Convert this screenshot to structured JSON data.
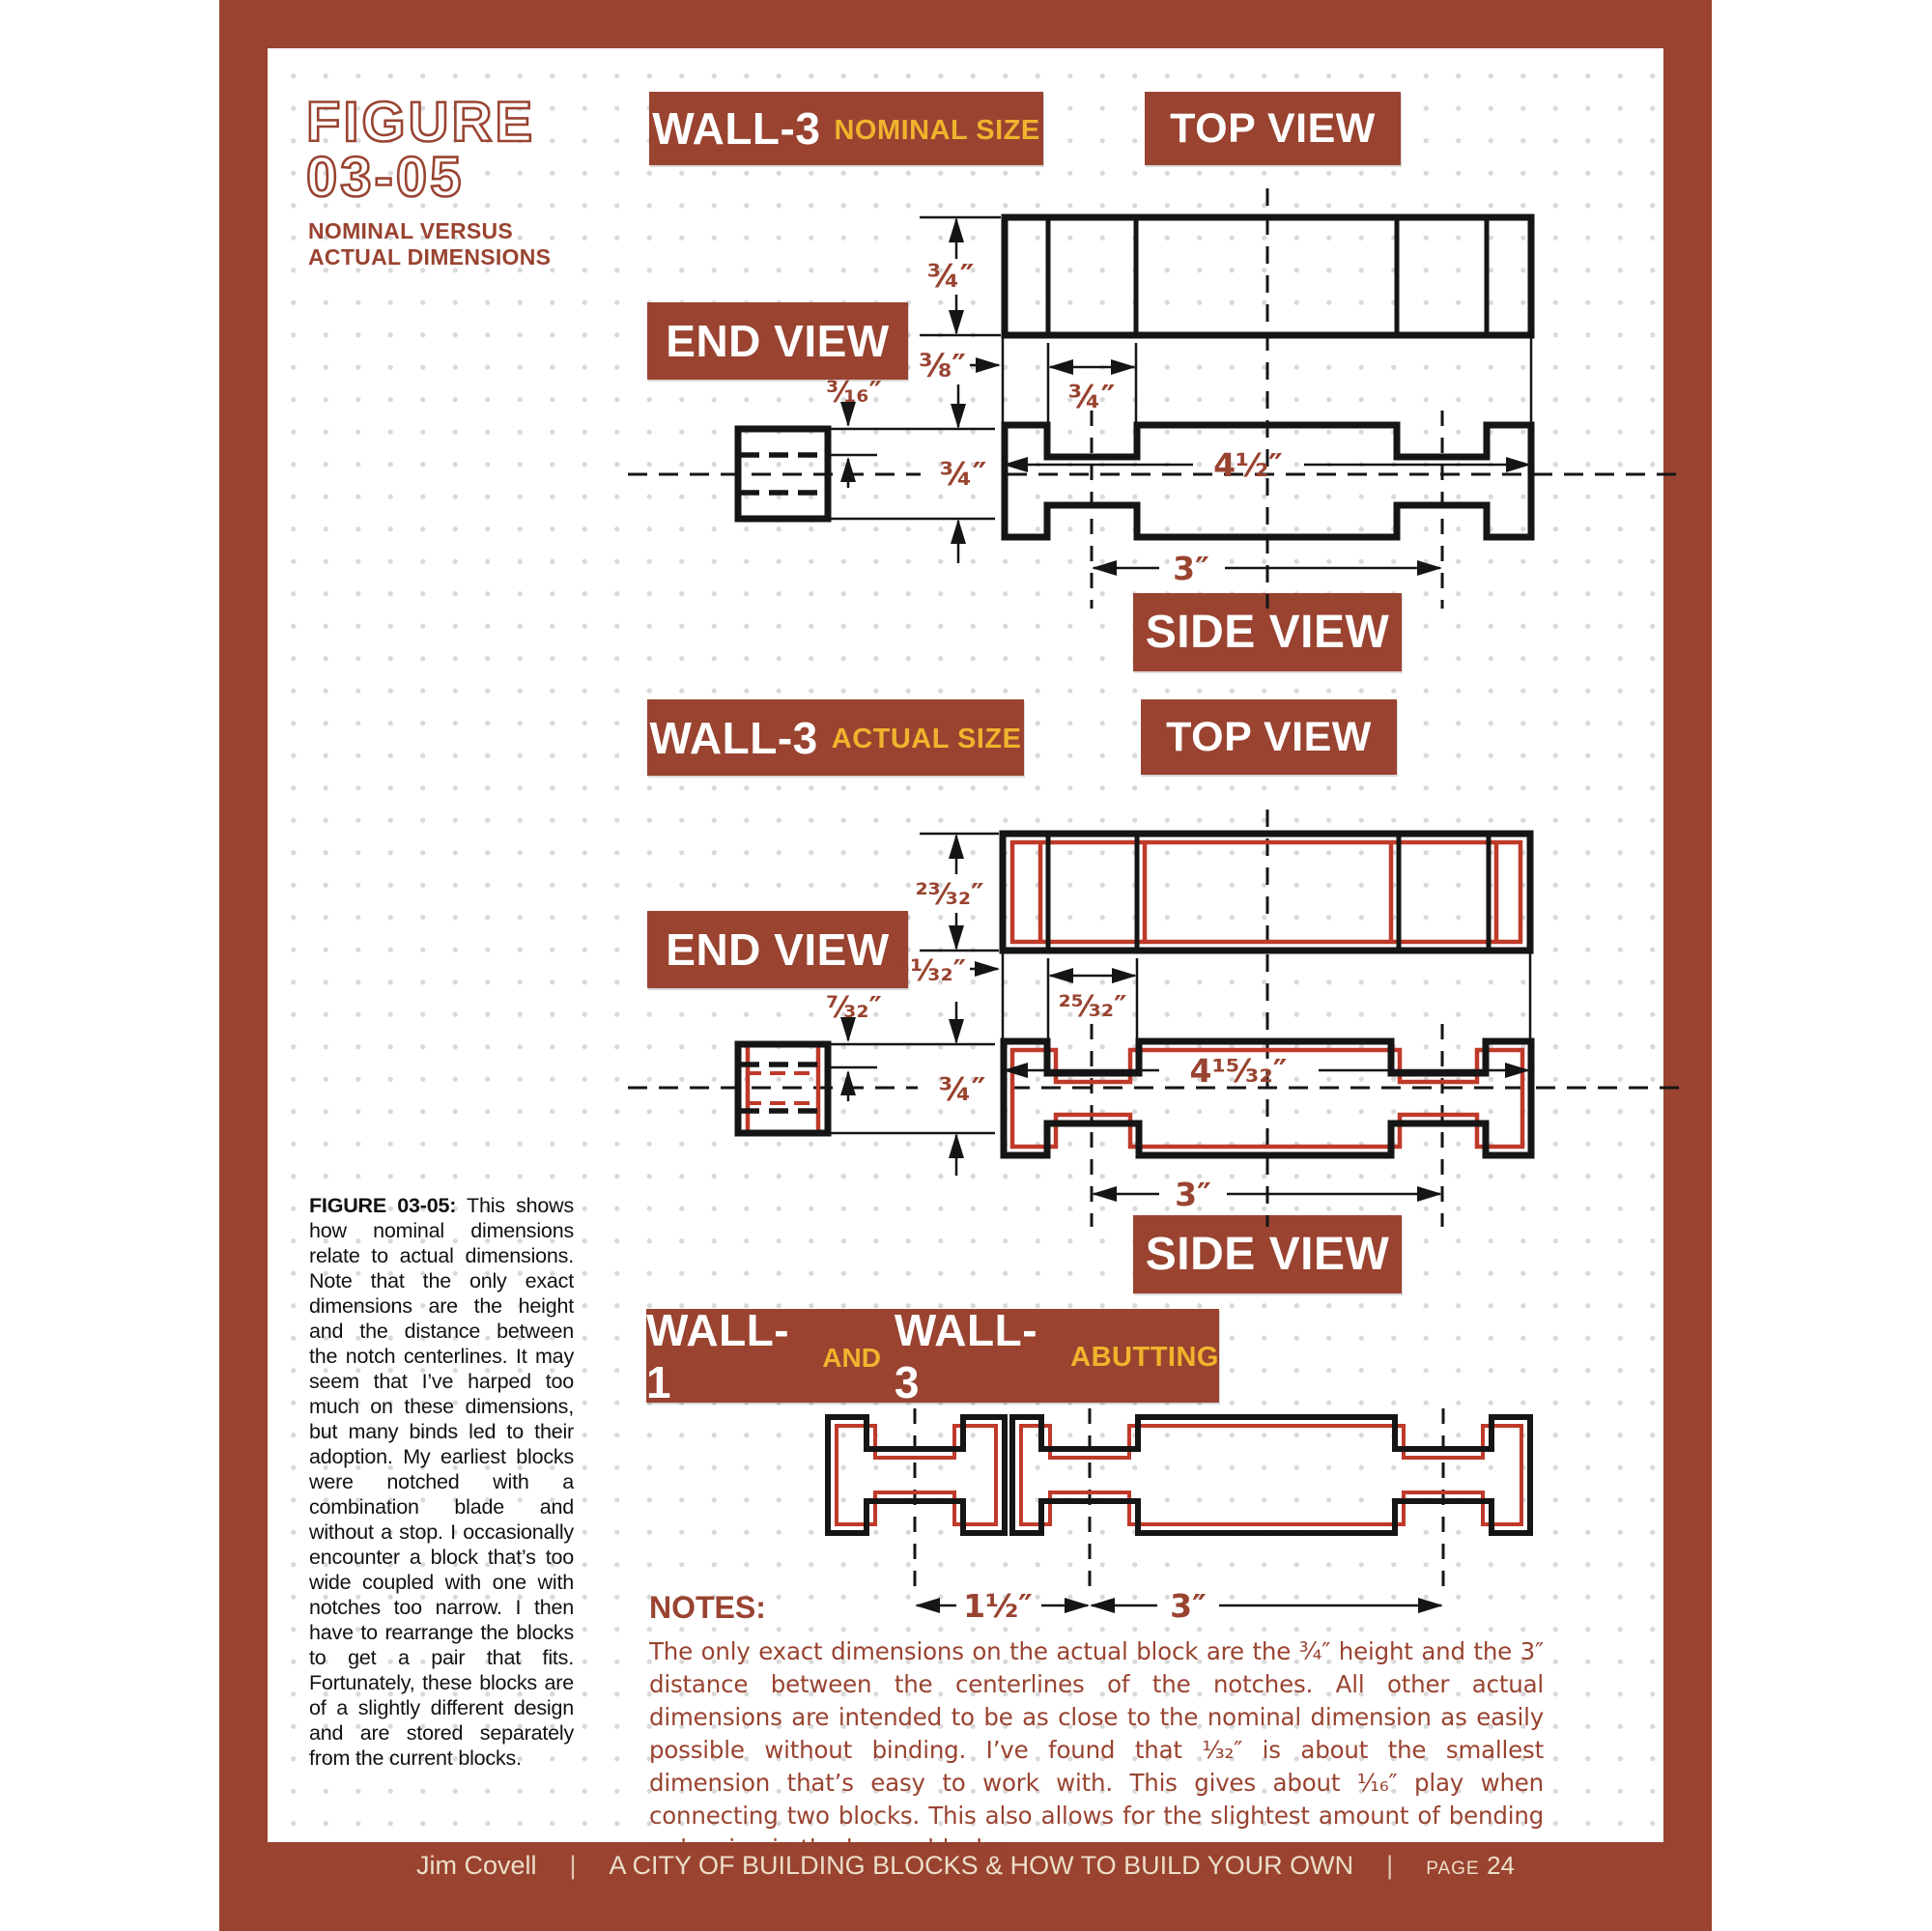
{
  "figure": {
    "label_line1": "FIGURE",
    "label_line2": "03-05",
    "subtitle_line1": "NOMINAL VERSUS",
    "subtitle_line2": "ACTUAL DIMENSIONS"
  },
  "colors": {
    "brick": "#994330",
    "accent_yellow": "#f0b32d",
    "overlay_red": "#bf3a2a",
    "ink": "#151515",
    "footer_text": "#ecdfc9"
  },
  "sections": {
    "nominal": {
      "title": "WALL-3",
      "title_suffix": "NOMINAL SIZE",
      "top_view_label": "TOP VIEW",
      "end_view_label": "END VIEW",
      "side_view_label": "SIDE VIEW",
      "dims": {
        "height": "¾″",
        "edge_offset": "⅜″",
        "notch_width": "¾″",
        "overall_length": "4½″",
        "end_offset": "³⁄₁₆″",
        "end_height": "¾″",
        "notch_spacing": "3″"
      }
    },
    "actual": {
      "title": "WALL-3",
      "title_suffix": "ACTUAL SIZE",
      "top_view_label": "TOP VIEW",
      "end_view_label": "END VIEW",
      "side_view_label": "SIDE VIEW",
      "dims": {
        "height": "²³⁄₃₂″",
        "edge_offset": "¹¹⁄₃₂″",
        "notch_width": "²⁵⁄₃₂″",
        "overall_length": "4¹⁵⁄₃₂″",
        "end_offset": "⁷⁄₃₂″",
        "end_height": "¾″",
        "notch_spacing": "3″"
      }
    },
    "abutting": {
      "title1": "WALL-1",
      "joiner": "AND",
      "title2": "WALL-3",
      "suffix": "ABUTTING",
      "dims": {
        "wall1_spacing": "1½″",
        "wall3_spacing": "3″"
      }
    }
  },
  "caption": {
    "lead": "FIGURE 03-05:",
    "body": " This shows how nominal dimensions relate to actual dimensions. Note that the only exact dimensions are the height and the distance between the notch centerlines. It may seem that I’ve harped too much on these dimensions, but many binds led to their adoption. My earliest blocks were notched with a combination blade and without a stop. I occasionally encounter a block that’s too wide coupled with one with notches too narrow. I then have to rearrange the blocks to get a pair that fits. Fortunately, these blocks are of a slightly different design and are stored separately from the current blocks."
  },
  "notes": {
    "heading": "NOTES:",
    "body": "The only exact dimensions on the actual block are the ¾″ height and the 3″ distance between the centerlines of the notches. All other actual dimensions are intended to be as close to the nominal dimension as easily possible without binding. I’ve found that ¹⁄₃₂″ is about the smallest dimension that’s easy to work with. This gives about ¹⁄₁₆″ play when connecting two blocks. This also allows for the slightest amount of bending or bowing in the longer blocks."
  },
  "footer": {
    "author": "Jim Covell",
    "separator": "|",
    "book_title": "A CITY OF BUILDING BLOCKS & HOW TO BUILD YOUR OWN",
    "page_label": "PAGE",
    "page_number": "24"
  }
}
